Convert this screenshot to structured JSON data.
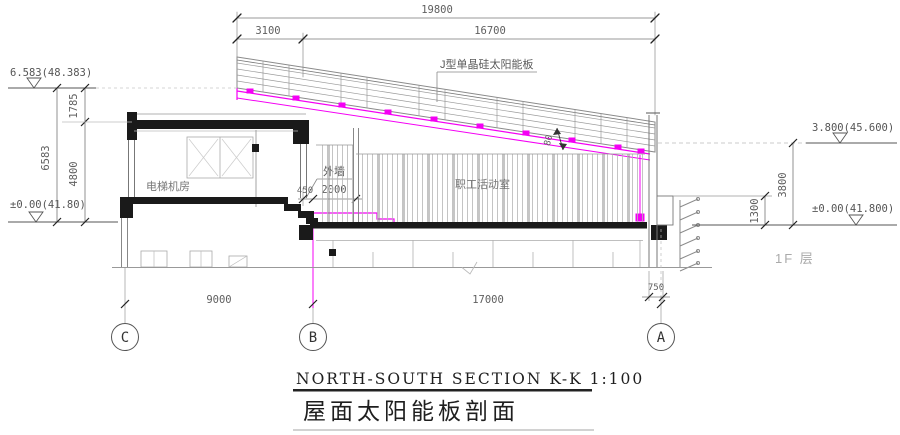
{
  "title": {
    "en": "NORTH-SOUTH SECTION  K-K  1:100",
    "zh": "屋面太阳能板剖面"
  },
  "labels": {
    "solar_panel": "J型单晶硅太阳能板",
    "exterior_wall": "外墙",
    "elevator_room": "电梯机房",
    "activity_room": "职工活动室",
    "floor_note": "1F 层"
  },
  "levels": {
    "left_top": "6.583(48.383)",
    "left_zero": "±0.00(41.80)",
    "right_mid": "3.800(45.600)",
    "right_zero": "±0.00(41.800)"
  },
  "dims": {
    "top_total": "19800",
    "top_seg1": "3100",
    "top_seg2": "16700",
    "left_total": "6583",
    "left_upper": "1785",
    "left_lower": "4800",
    "right_height": "3800",
    "right_parapet": "1300",
    "bay_cb": "9000",
    "bay_ba": "17000",
    "offset_a": "750",
    "parapet_width": "450",
    "roof_strip": "2000",
    "panel_gap": "80"
  },
  "axes": {
    "c": "C",
    "b": "B",
    "a": "A"
  },
  "colors": {
    "magenta": "#f400f4",
    "ink": "#1a1a1a",
    "line_gray": "#8a8a8a",
    "dim_text": "#5a5a5a"
  }
}
